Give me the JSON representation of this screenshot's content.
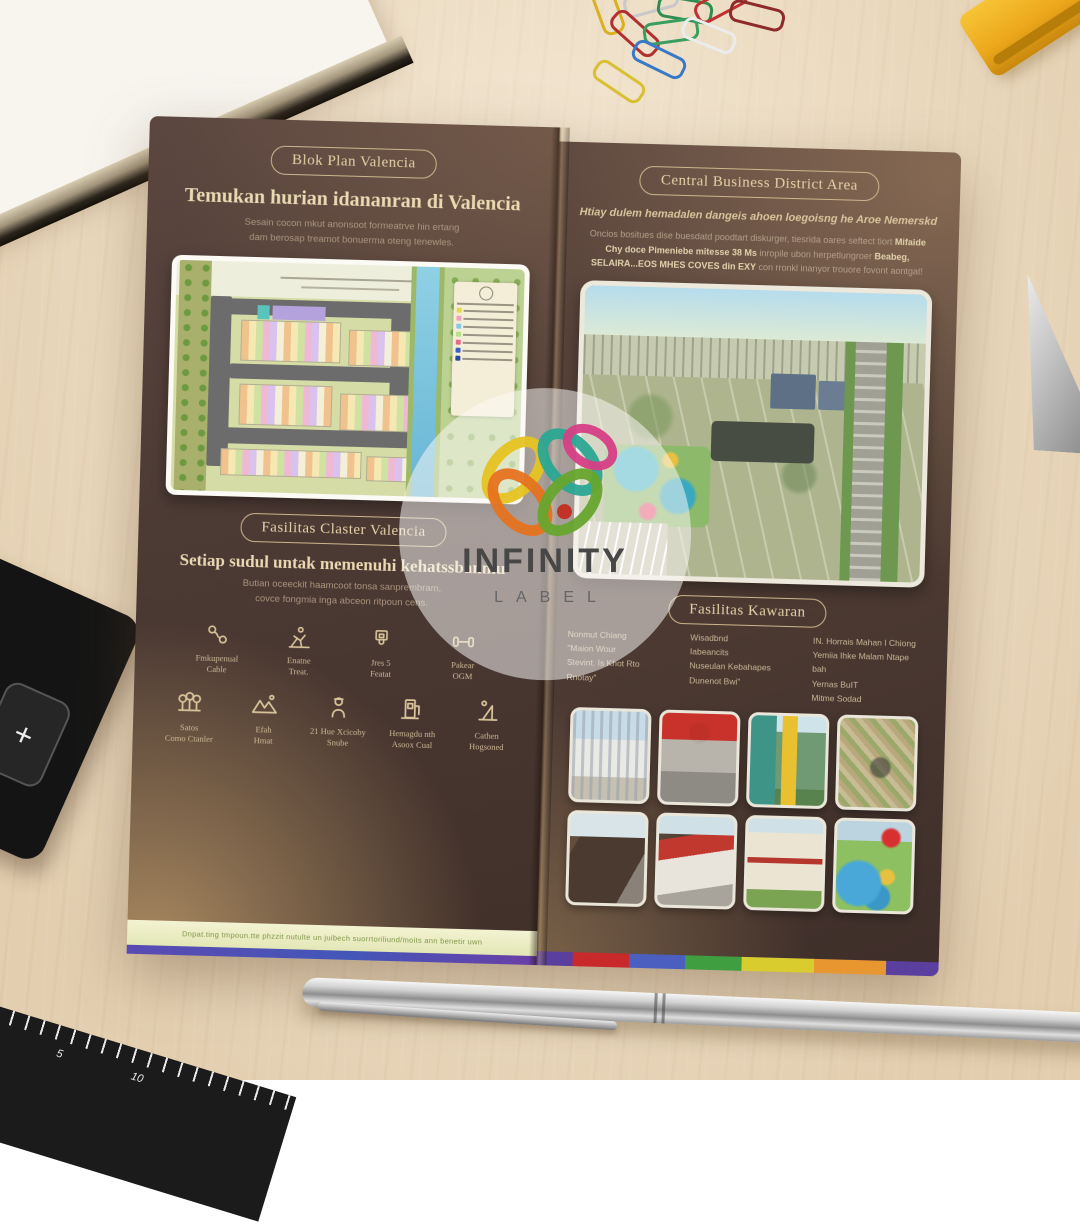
{
  "watermark": {
    "title": "INFINITY",
    "subtitle": "LABEL"
  },
  "brochure": {
    "left_panel": {
      "badge": "Blok Plan Valencia",
      "heading": "Temukan hurian idananran di Valencia",
      "intro": "Sesain cocon mkut anonsoot formeatrve hin ertang\ndam berosap treamot bonuerma oteng tenewles.",
      "facilities_badge": "Fasilitas Claster Valencia",
      "facilities_heading": "Setiap sudul untak memenuhi kehatssbanmu",
      "facilities_intro": "Butian oceeckit haamcoot tonsa sanprembram,\ncovce fongmia inga abceon ritpoun cens.",
      "amenities_row1": [
        {
          "icon": "cable-icon",
          "label": "Fmkupenual\nCable"
        },
        {
          "icon": "jogging-track-icon",
          "label": "Enatne\nTreat."
        },
        {
          "icon": "basketball-hoop-icon",
          "label": "Jres 5\nFeatat"
        },
        {
          "icon": "dumbbell-icon",
          "label": "Pakear\nOGM"
        }
      ],
      "amenities_row2": [
        {
          "icon": "trees-icon",
          "label": "Satos\nComo Ctanler"
        },
        {
          "icon": "mountains-icon",
          "label": "Efah\nHmat"
        },
        {
          "icon": "security-guard-icon",
          "label": "21 Hue Xcicoby\nSnube"
        },
        {
          "icon": "charging-station-icon",
          "label": "Hemagdu nth\nAsoox Cual"
        },
        {
          "icon": "playground-icon",
          "label": "Cathen\nHogsoned"
        }
      ],
      "footer_note": "Dnpat.ting tmpoun.tte phzzit nutulte un juibech suorrtoriliund/moits ann benetir uwn"
    },
    "right_panel": {
      "badge": "Central Business District Area",
      "lead": "Htiay dulem hemadalen dangeis ahoen loegoisng he Aroe Nemerskd",
      "body_parts": {
        "p1": "Oncios bositues dise buesdatd poodtart diskurger, tiesrida oares seftect tiort ",
        "p2": "Mifaide Chy doce Pimeniebe mitesse 38 Ms",
        "p3": " inropile ubon herpetlungroer ",
        "p4": "Beabeg, SELAIRA...EOS MHES COVES din EXY",
        "p5": " con rronkl inanyor trouore fovont aontgat!"
      },
      "facilities_badge": "Fasilitas Kawaran",
      "columns": {
        "col1": "Nonmut Chiang\n\"Maion Wour\nStevint. Is Khot Rto\nRnotay\"",
        "col2": "Wisadbnd\nIabeancits\nNuseulan Kebahapes\nDunenot Bwi\"",
        "col3": "IN. Horrais Mahan I Chiong\nYemiia Ihke Malam Ntape bah\nYernas BuIT\nMitme Sodad"
      },
      "photos": [
        "office-building",
        "motorcycle-dealer",
        "campus-building",
        "city-aerial",
        "museum-building",
        "red-roof-store",
        "hospital-building",
        "waterpark"
      ]
    }
  },
  "scene": {
    "objects": [
      "notebook",
      "paper-clips",
      "yellow-cutter",
      "scissors-blade",
      "calculator",
      "ruler",
      "silver-pen",
      "wooden-desk"
    ],
    "calculator_key": "+",
    "ruler_numbers": {
      "n1": "5",
      "n2": "10"
    }
  },
  "colors": {
    "panel_brown": "#4c3a34",
    "gold_text": "#e0cba2",
    "desk_wood": "#e9d7ba",
    "strip_yellow": "#eff0cc",
    "rainbow": [
      "#5b3f9e",
      "#c8292b",
      "#4a5fc0",
      "#3f9e3f",
      "#d8cc2f",
      "#e8962f"
    ]
  }
}
